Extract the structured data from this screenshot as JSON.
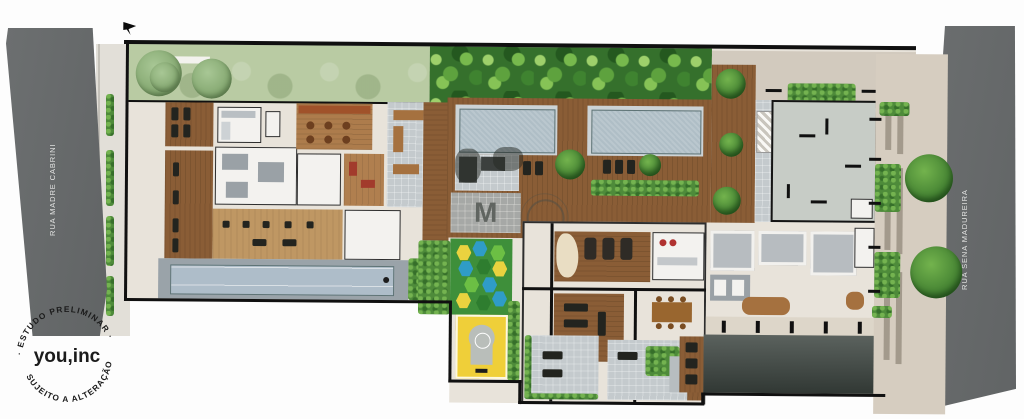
{
  "streets": {
    "left_label": "RUA MADRE CABRINI",
    "right_label": "RUA SENA MADUREIRA"
  },
  "stamp": {
    "arc_top": "· ESTUDO PRELIMINAR ·",
    "arc_bottom": "SUJEITO A ALTERAÇÃO",
    "brand": "you,inc"
  },
  "watermark": {
    "letter": "M"
  },
  "colors": {
    "street": "#6c6f70",
    "street_label": "#e4e5e3",
    "sidewalk_left": "#e2dfd8",
    "sidewalk_right": "#d6cdc0",
    "lawn": "#b9cba3",
    "tropical": "#35702c",
    "wood_deck": "#8a5d36",
    "wood_floor": "#bf9763",
    "floor": "#e8e3da",
    "pool": "#afbec6",
    "pavers": "#c4cacd",
    "tower": "#c7ccc6",
    "hedge": "#4e8b3a",
    "play_grass": "#3e8f3a",
    "court_yellow": "#efcf39",
    "driveway": "#3c423f",
    "boundary": "#101010",
    "stamp_ink": "#1b1b1b"
  }
}
